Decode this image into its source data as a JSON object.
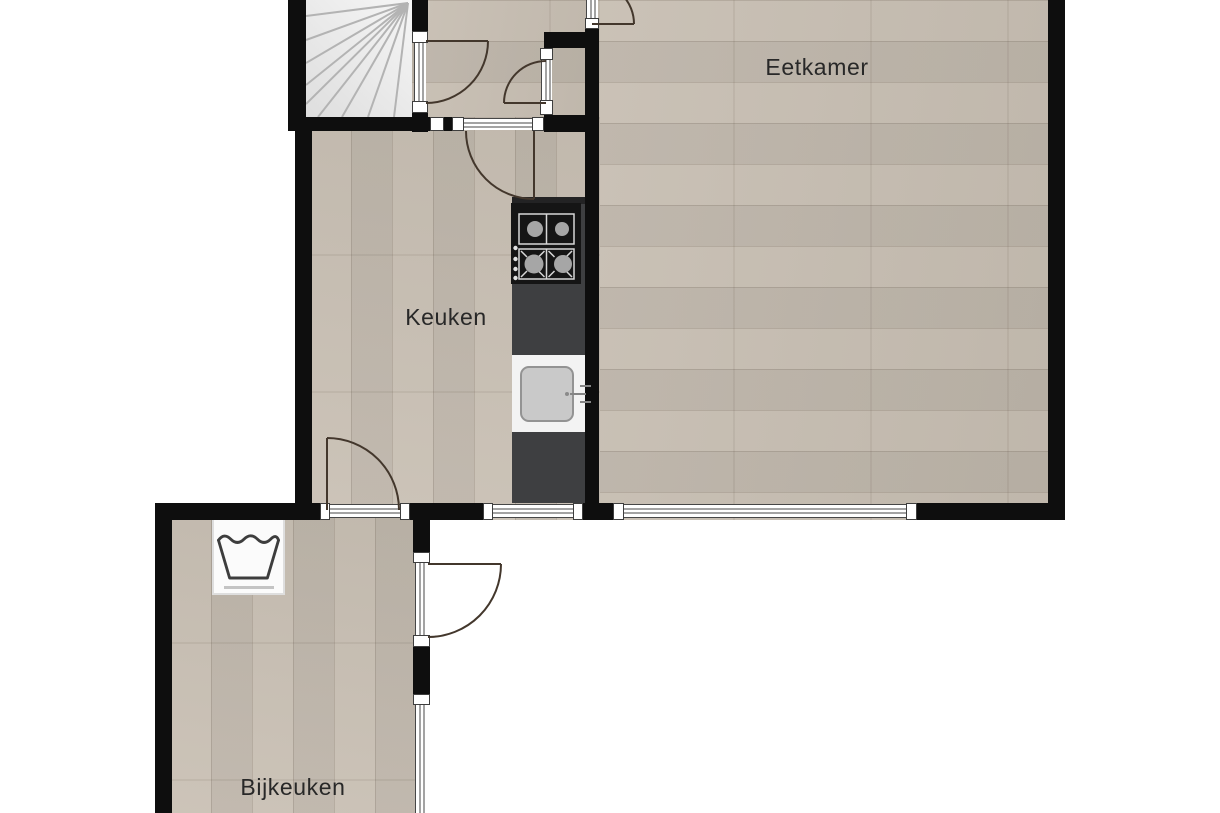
{
  "plan": {
    "rooms": [
      {
        "id": "eetkamer",
        "label": "Eetkamer"
      },
      {
        "id": "keuken",
        "label": "Keuken"
      },
      {
        "id": "bijkeuken",
        "label": "Bijkeuken"
      }
    ],
    "fixtures": {
      "stove": "gas-hob-4-burners",
      "sink": "kitchen-sink",
      "washer": "washing-machine",
      "stairs": "winder-staircase",
      "doors": 6,
      "windows": 4
    },
    "colors": {
      "background": "#ffffff",
      "wall": "#0e0e0e",
      "floor": "#c7beb2",
      "counter": "#3e3f41",
      "stairs": "#ebebeb",
      "door_arc": "#43372c"
    }
  }
}
